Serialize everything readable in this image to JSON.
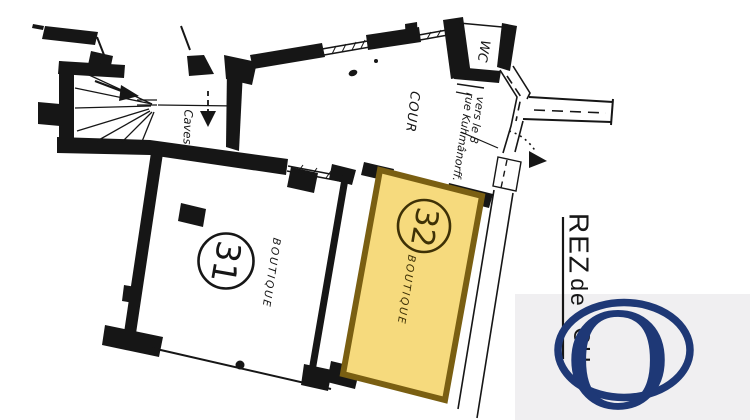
{
  "colors": {
    "background": "#ffffff",
    "ink": "#161616",
    "room32_fill": "#f6da7d",
    "room32_border": "#7a5f12",
    "room32_ink": "#3e3106",
    "logo_navy": "#1e3876",
    "watermark_bg": "#f0eff1"
  },
  "plan": {
    "labels": {
      "cour": "COUR",
      "wc": "WC",
      "caves": "Caves",
      "direction_line1": "vers le 8",
      "direction_line2": "rue Kuhmânorff."
    },
    "rooms": [
      {
        "number": "31",
        "label": "BOUTIQUE",
        "highlighted": false
      },
      {
        "number": "32",
        "label": "BOUTIQUE",
        "highlighted": true
      }
    ],
    "floor_label": {
      "part1": "REZ",
      "part2": "de",
      "part3": "CH"
    }
  },
  "watermark": {
    "letter": "O"
  }
}
